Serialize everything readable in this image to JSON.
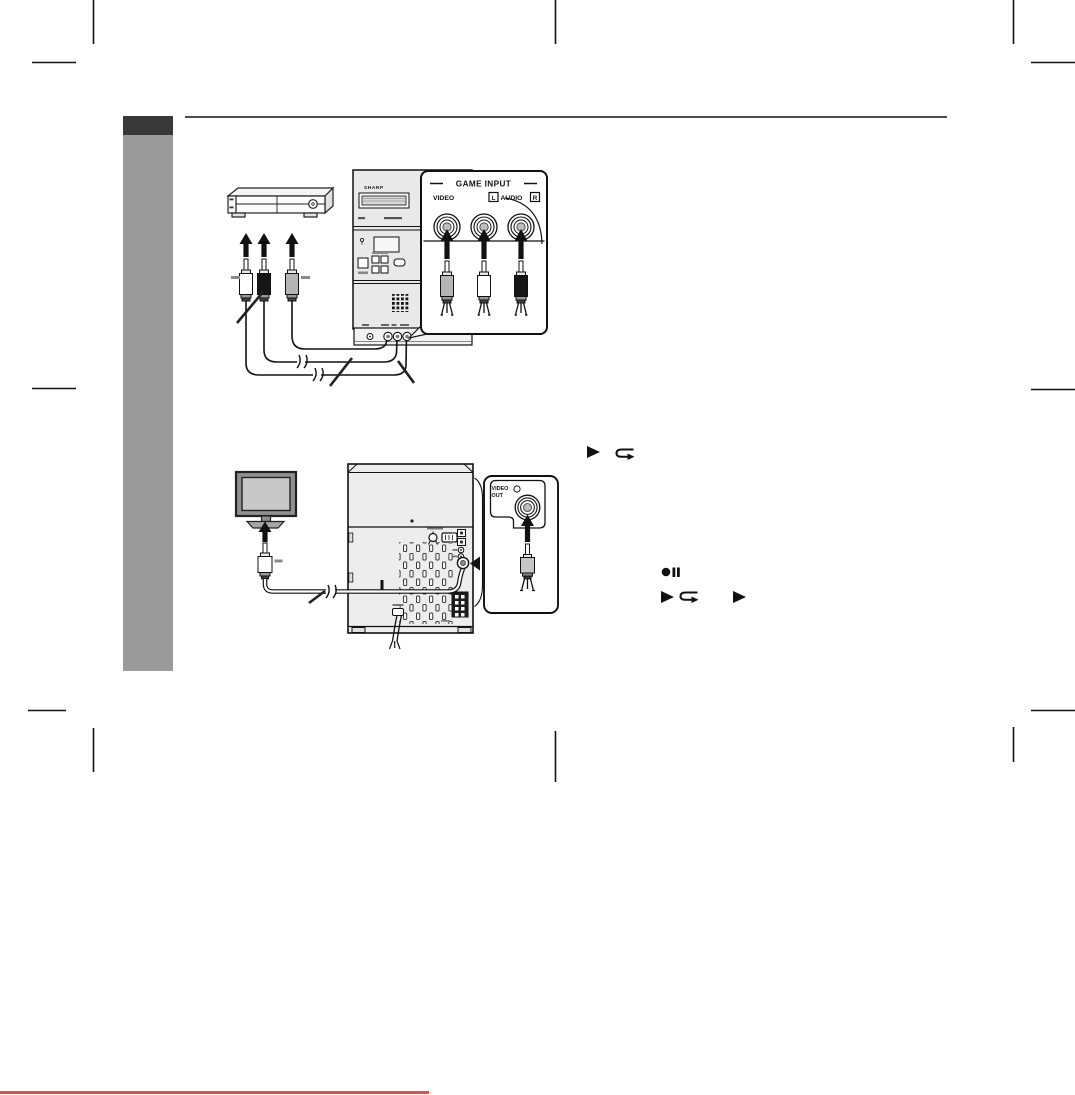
{
  "labels": {
    "brand": "SHARP",
    "game_input_title": "GAME INPUT",
    "video": "VIDEO",
    "audio_l": "L",
    "audio": "AUDIO",
    "audio_r": "R",
    "video_out_line1": "VIDEO",
    "video_out_line2": "OUT"
  },
  "colors": {
    "sidebar_tab": "#383838",
    "sidebar_body": "#9b9b9b",
    "footer_line": "#f4493d",
    "ink": "#111111",
    "plug_video": "#b5b5b5",
    "plug_left": "#ffffff",
    "plug_right": "#161616"
  },
  "icons": [
    {
      "name": "play-icon",
      "glyph": "▶"
    },
    {
      "name": "loop-return-icon",
      "glyph": "↩"
    },
    {
      "name": "record-pause-icon",
      "glyph": "●❚❚"
    }
  ]
}
